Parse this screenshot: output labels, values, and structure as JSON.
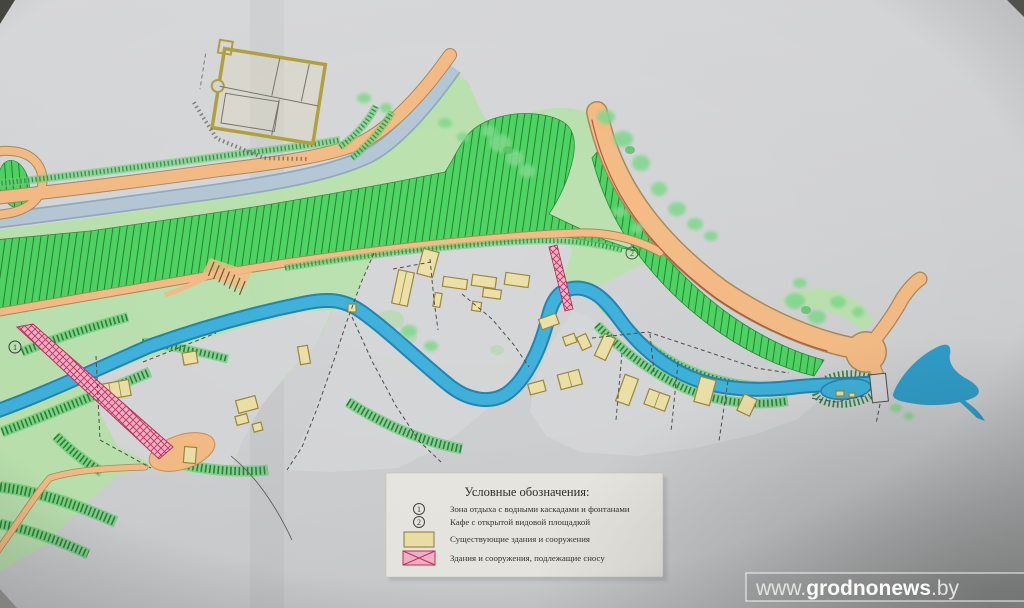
{
  "photo": {
    "description": "Photograph of a hand-drawn landscape development plan (park / riverside reconstruction scheme)",
    "watermark": {
      "prefix": "www.",
      "brand": "grodnonews",
      "suffix": ".by"
    }
  },
  "legend": {
    "title": "Условные обозначения:",
    "items": [
      {
        "symbol": "circled-1",
        "marker": "1",
        "label": "Зона отдыха с водными каскадами и фонтанами"
      },
      {
        "symbol": "circled-2",
        "marker": "2",
        "label": "Кафе с открытой видовой площадкой"
      },
      {
        "symbol": "existing-building-swatch",
        "label": "Существующие здания и сооружения"
      },
      {
        "symbol": "demolition-swatch",
        "label": "Здания и сооружения, подлежащие сносу"
      }
    ]
  },
  "map_markers": {
    "marker1": "1",
    "marker2": "2"
  },
  "colors": {
    "paper": "#d6d7d8",
    "road_orange": "#f5bc86",
    "river_blue": "#3fb2dc",
    "canal_blue": "#b6c8d6",
    "lawn_green": "#bae3ae",
    "slope_green": "#4fd463",
    "tree_green": "#80d98d",
    "building_fill": "#ece1a8",
    "building_stroke": "#99893a",
    "demolition_pink": "#f3b3c9",
    "demolition_red": "#c23160"
  }
}
